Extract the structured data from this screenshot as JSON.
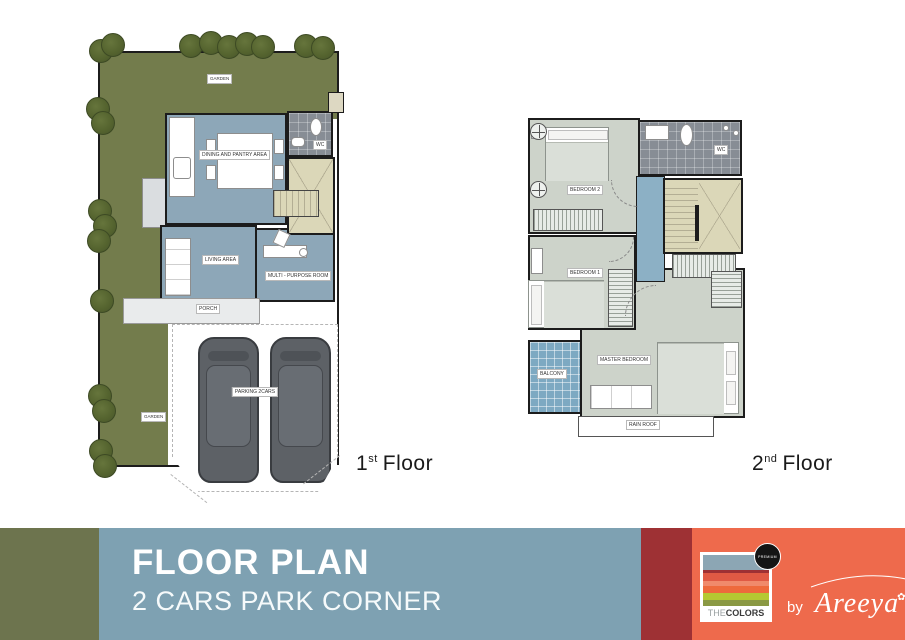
{
  "floors": {
    "first": {
      "caption": {
        "num": "1",
        "sup": "st",
        "word": "Floor"
      },
      "rooms": {
        "garden_top": "GARDEN",
        "garden_side": "GARDEN",
        "dining": "DINING AND PANTRY AREA",
        "wc": "WC",
        "living": "LIVING AREA",
        "multi_purpose": "MULTI - PURPOSE ROOM",
        "porch": "PORCH",
        "parking": "PARKING 2CARS"
      }
    },
    "second": {
      "caption": {
        "num": "2",
        "sup": "nd",
        "word": "Floor"
      },
      "rooms": {
        "bedroom2": "BEDROOM 2",
        "wc": "WC",
        "bedroom1": "BEDROOM 1",
        "master": "MASTER BEDROOM",
        "balcony": "BALCONY",
        "rain_roof": "RAIN ROOF"
      }
    }
  },
  "banner": {
    "title": "FLOOR PLAN",
    "subtitle": "2 CARS PARK CORNER",
    "logo": {
      "the": "THE",
      "colors": "COLORS",
      "badge": "PREMIUM"
    },
    "byline": {
      "by": "by",
      "brand": "Areeya"
    }
  },
  "colors": {
    "garden": "#737c4c",
    "floor_blue": "#8da7b8",
    "room_gray": "#cdd3ca",
    "stair_beige": "#dbd7b8",
    "tile_gray": "#878d95",
    "balcony_blue": "#7da9c2",
    "wall": "#1c1c1c",
    "banner_olive": "#6d744e",
    "banner_blue": "#7ea1b2",
    "banner_maroon": "#9e3134",
    "banner_orange": "#ee6a4c"
  }
}
